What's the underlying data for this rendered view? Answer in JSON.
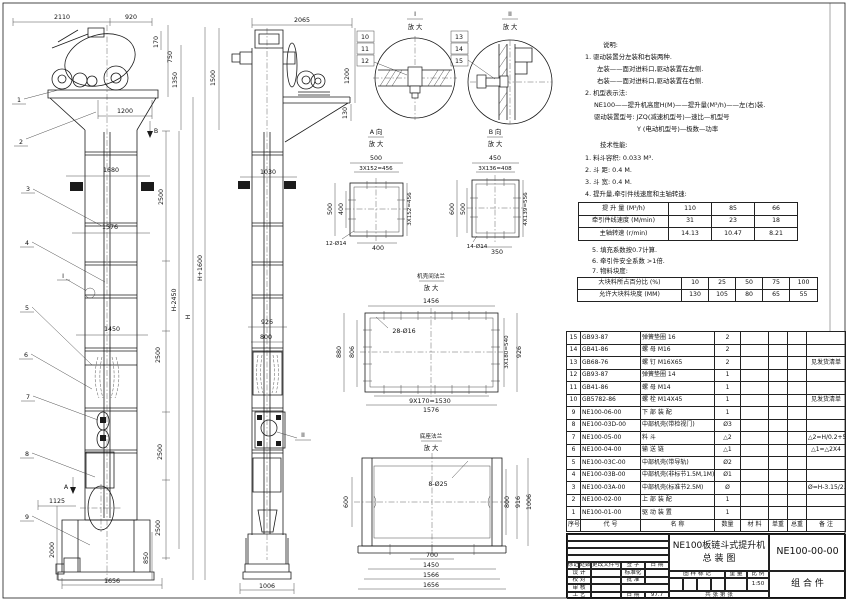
{
  "fv": [
    "2110",
    "920",
    "170",
    "750",
    "1350",
    "1500",
    "1200",
    "B",
    "1680",
    "2500",
    "1576",
    "H+1600",
    "H-2450",
    "H",
    "1450",
    "2500",
    "2500",
    "1125",
    "A",
    "2500",
    "2000",
    "850",
    "1656",
    "I"
  ],
  "fl": [
    "1",
    "2",
    "3",
    "4",
    "5",
    "6",
    "7",
    "8",
    "9"
  ],
  "sv": [
    "2065",
    "1200",
    "130",
    "1030",
    "926",
    "800",
    "II",
    "1006"
  ],
  "detail_i": {
    "label": "I",
    "zoom": "放 大",
    "parts": [
      "10",
      "11",
      "12"
    ]
  },
  "detail_ii": {
    "label": "II",
    "zoom": "放 大",
    "parts": [
      "13",
      "14",
      "15"
    ]
  },
  "view_a": {
    "label": "A 向",
    "zoom": "放 大",
    "dims": [
      "500",
      "3X152=456",
      "500",
      "400",
      "3X152=456",
      "12-Ø14",
      "400"
    ]
  },
  "view_b": {
    "label": "B 向",
    "zoom": "放 大",
    "dims": [
      "450",
      "3X136=408",
      "600",
      "500",
      "4X139=556",
      "14-Ø14",
      "350"
    ]
  },
  "flange": {
    "label": "机壳间法兰",
    "zoom": "放 大",
    "dims": [
      "1456",
      "28-Ø16",
      "880",
      "806",
      "3X180=540",
      "926",
      "9X170=1530",
      "1576"
    ]
  },
  "base": {
    "label": "底座法兰",
    "zoom": "放 大",
    "dims": [
      "8-Ø25",
      "600",
      "800",
      "916",
      "1006",
      "700",
      "1450",
      "1566",
      "1656"
    ]
  },
  "notes": {
    "title": "说明:",
    "lines": [
      "1. 驱动装置分左装和右装两种.",
      "左装——面对进料口,驱动装置在左侧.",
      "右装——面对进料口,驱动装置在右侧.",
      "2. 机型表示法:",
      "NE100——提升机高度H(M)——提升量(M³/h)——左(右)装.",
      "驱动装置型号: JZQ(减速机型号)—速比—机型号",
      "Y (电动机型号)—极数—功率"
    ]
  },
  "tech": {
    "title": "技术性能:",
    "lines": [
      "1. 料斗容积: 0.033 M³.",
      "2. 斗   距: 0.4 M.",
      "3. 斗   宽: 0.4 M.",
      "4. 提升量,牵引件线速度和主轴转速:"
    ]
  },
  "spec": {
    "rows": [
      [
        "提 升 量 (M³/h)",
        "110",
        "85",
        "66"
      ],
      [
        "牵引件线速度 (M/min)",
        "31",
        "23",
        "18"
      ],
      [
        "主轴转速 (r/min)",
        "14.13",
        "10.47",
        "8.21"
      ]
    ]
  },
  "notes2": [
    "5. 填充系数按0.7计算.",
    "6. 牵引件安全系数 >1倍.",
    "7. 物料块度:"
  ],
  "lump": {
    "rows": [
      [
        "大块料所占百分比 (%)",
        "10",
        "25",
        "50",
        "75",
        "100"
      ],
      [
        "允许大块料块度 (MM)",
        "130",
        "105",
        "80",
        "65",
        "55"
      ]
    ]
  },
  "bom": {
    "headers": [
      "序号",
      "代  号",
      "名  称",
      "数量",
      "材 料",
      "单重",
      "总重",
      "备  注"
    ],
    "rows": [
      {
        "no": "15",
        "code": "GB93-87",
        "name": "弹簧垫圈  16",
        "qty": "2",
        "remark": ""
      },
      {
        "no": "14",
        "code": "GB41-86",
        "name": "螺 母  M16",
        "qty": "2",
        "remark": ""
      },
      {
        "no": "13",
        "code": "GB68-76",
        "name": "螺 钉  M16X65",
        "qty": "2",
        "remark": "见发货清单"
      },
      {
        "no": "12",
        "code": "GB93-87",
        "name": "弹簧垫圈  14",
        "qty": "1",
        "remark": ""
      },
      {
        "no": "11",
        "code": "GB41-86",
        "name": "螺 母  M14",
        "qty": "1",
        "remark": ""
      },
      {
        "no": "10",
        "code": "GB5782-86",
        "name": "螺 栓  M14X45",
        "qty": "1",
        "remark": "见发货清单"
      },
      {
        "no": "9",
        "code": "NE100-06-00",
        "name": "下 部 装 配",
        "qty": "1",
        "remark": ""
      },
      {
        "no": "8",
        "code": "NE100-03D-00",
        "name": "中部机壳(带检视门)",
        "qty": "Ø3",
        "remark": ""
      },
      {
        "no": "7",
        "code": "NE100-05-00",
        "name": "料  斗",
        "qty": "△2",
        "remark": "△2=H/0.2+5.75"
      },
      {
        "no": "6",
        "code": "NE100-04-00",
        "name": "输 送 链",
        "qty": "△1",
        "remark": "△1=△2X4"
      },
      {
        "no": "5",
        "code": "NE100-03C-00",
        "name": "中部机壳(带导轨)",
        "qty": "Ø2",
        "remark": ""
      },
      {
        "no": "4",
        "code": "NE100-03B-00",
        "name": "中部机壳(非标节1.5M,1M)",
        "qty": "Ø1",
        "remark": ""
      },
      {
        "no": "3",
        "code": "NE100-03A-00",
        "name": "中部机壳(标准节2.5M)",
        "qty": "Ø",
        "remark": "Ø=H-3.15/2.5"
      },
      {
        "no": "2",
        "code": "NE100-02-00",
        "name": "上 部 装 配",
        "qty": "1",
        "remark": ""
      },
      {
        "no": "1",
        "code": "NE100-01-00",
        "name": "驱 动 装 置",
        "qty": "1",
        "remark": ""
      }
    ]
  },
  "title_block": {
    "title_line1": "NE100板链斗式提升机",
    "title_line2": "总  装  图",
    "drawing_no": "NE100-00-00",
    "part_type": "组 合 件",
    "rev_headers": [
      "标记",
      "处数",
      "更改文件号",
      "签 字",
      "日 期"
    ],
    "sig_design": "设 计",
    "sig_check": "校 对",
    "sig_audit": "审 核",
    "sig_process": "工 艺",
    "sig_std": "标准化",
    "sig_approve": "批 准",
    "sig_date": "日 期",
    "date_value": "97.7",
    "stamp_header": "图 样 标 记",
    "weight_header": "重 量",
    "scale_header": "比 例",
    "scale": "1:50",
    "sheet_info": "共  张  第  张"
  }
}
